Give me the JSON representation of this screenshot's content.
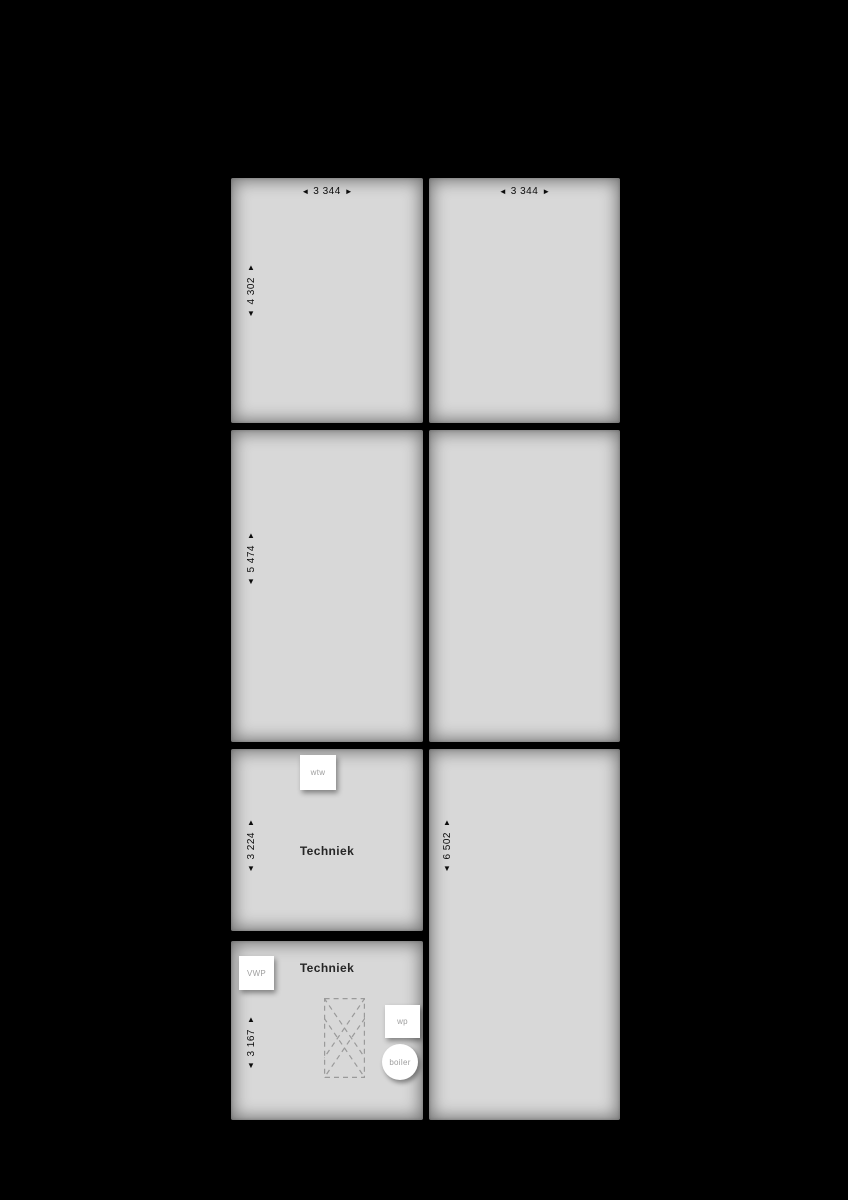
{
  "plan": {
    "colors": {
      "background": "#000000",
      "room_fill": "#d8d8d8",
      "equipment_fill": "#ffffff",
      "dimension_text": "#0c0c0c",
      "equipment_text": "#9e9e9e",
      "dashed_line": "#9a9a9a"
    },
    "glyphs": {
      "left": "◄",
      "right": "►",
      "up": "▲",
      "down": "▼"
    },
    "rooms": {
      "top_left": {
        "width": "3 344",
        "height": "4 302"
      },
      "top_right": {
        "width": "3 344"
      },
      "mid_left": {
        "height": "5 474"
      },
      "mid_right": {},
      "tech_upper": {
        "name": "Techniek",
        "height": "3 224"
      },
      "right_tall": {
        "height": "6 502"
      },
      "tech_lower": {
        "name": "Techniek",
        "height": "3 167"
      }
    },
    "equipment": {
      "wtw": "wtw",
      "vwp": "VWP",
      "wp": "wp",
      "boiler": "boiler"
    }
  }
}
